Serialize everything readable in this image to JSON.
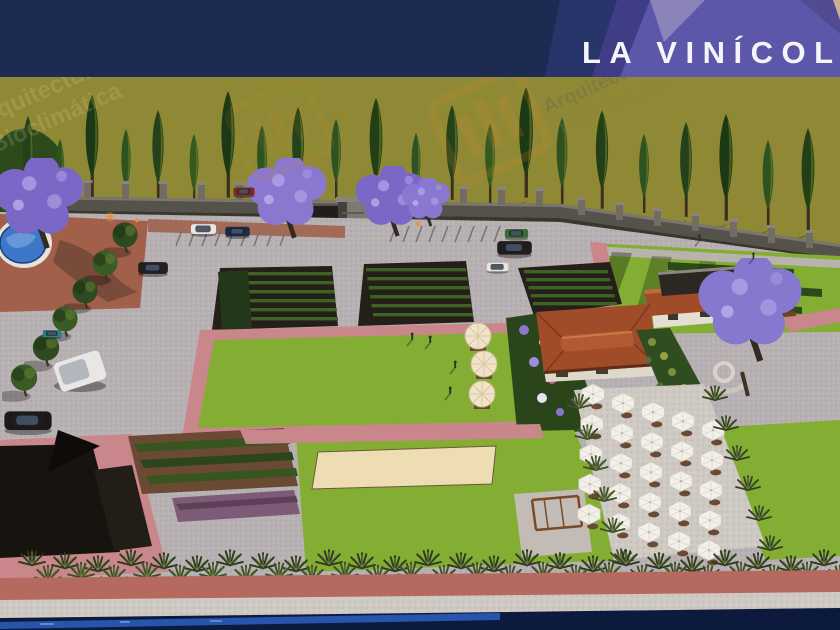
{
  "banner": {
    "title": "LA VINÍCOL",
    "navy": "#1d2b52",
    "navy_light": "#27356a",
    "indigo": "#3f3d85",
    "purple": "#5d57a9",
    "purple_light": "#8a84bb",
    "purple_dark": "#514b93",
    "tan_corner": "#cdb096",
    "title_color": "#f5f4f8"
  },
  "watermark": {
    "line1": "Arquitectura",
    "line2": "Bioclimática",
    "logo_color": "#d98b2b",
    "text_color": "#e8dca2"
  },
  "palette": {
    "olive_field": "#8f8936",
    "lawn": "#83ad33",
    "path_pink": "#c9868b",
    "brick": "#a2604a",
    "paving": "#b8b1b3",
    "water": "#0c1a3e",
    "water_light": "#2a5cb8",
    "umbrella": "#f3f0e9",
    "jacaranda": "#8678cf",
    "roof_terracotta": "#a14c28",
    "sand": "#eeddb2",
    "vine_soil": "#241f18",
    "vine_row": "#3f6323",
    "wall_stone": "#55524c",
    "agave_green": "#3d4f28",
    "band_brick": "#b5695f",
    "band_gravel": "#cfc9c4"
  }
}
